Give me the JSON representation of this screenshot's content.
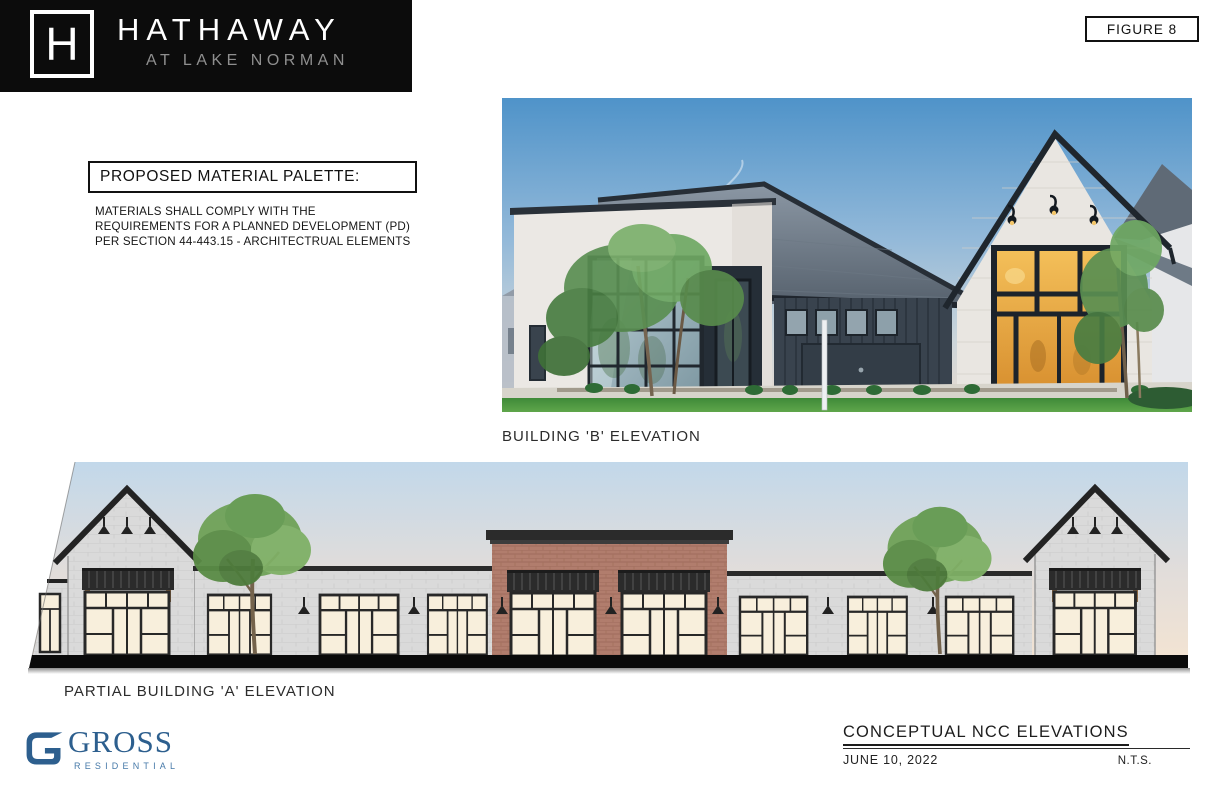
{
  "header": {
    "logo": {
      "monogram": "H",
      "title": "HATHAWAY",
      "subtitle": "AT LAKE NORMAN"
    },
    "figure_label": "FIGURE 8"
  },
  "material_palette": {
    "heading": "PROPOSED MATERIAL PALETTE:",
    "body_lines": [
      "MATERIALS SHALL COMPLY WITH THE",
      "REQUIREMENTS FOR A PLANNED DEVELOPMENT (PD)",
      "PER SECTION 44-443.15 - ARCHITECTRUAL ELEMENTS"
    ]
  },
  "elevations": {
    "building_b_caption": "BUILDING 'B' ELEVATION",
    "building_a_caption": "PARTIAL BUILDING 'A' ELEVATION"
  },
  "title_block": {
    "title": "CONCEPTUAL NCC ELEVATIONS",
    "date": "JUNE 10, 2022",
    "scale": "N.T.S."
  },
  "footer_logo": {
    "name": "GROSS",
    "subtitle": "RESIDENTIAL"
  },
  "colors": {
    "banner_black": "#0c0c0c",
    "gross_blue": "#2d5f8e",
    "brick": "#b17d6d",
    "stone_gray": "#dadada",
    "awning_dark": "#2b2b2b",
    "glass_warm": "#f8efdc",
    "window_glow": "#eca93f"
  }
}
